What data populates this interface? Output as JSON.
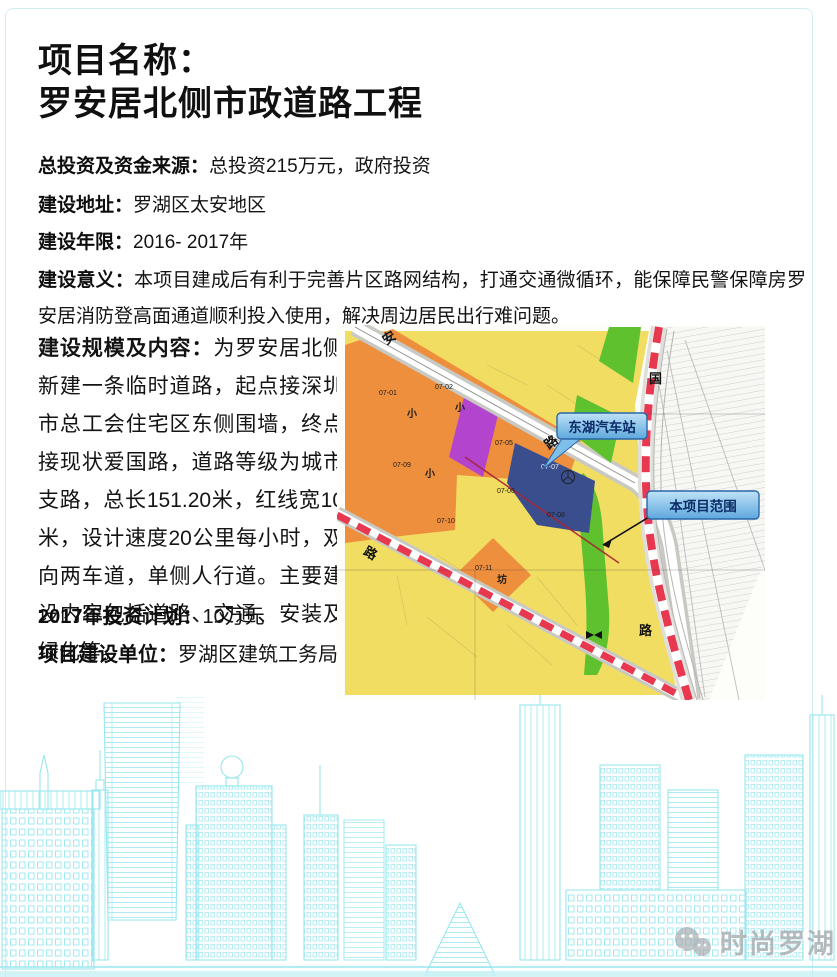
{
  "page": {
    "title_line1": "项目名称：",
    "title_line2": "罗安居北侧市政道路工程"
  },
  "fields": [
    {
      "label": "总投资及资金来源：",
      "value": "总投资215万元，政府投资"
    },
    {
      "label": "建设地址：",
      "value": "罗湖区太安地区"
    },
    {
      "label": "建设年限：",
      "value": "2016- 2017年"
    },
    {
      "label": "建设意义：",
      "value": "本项目建成后有利于完善片区路网结构，打通交通微循环，能保障民警保障房罗安居消防登高面通道顺利投入使用，解决周边居民出行难问题。"
    }
  ],
  "scale": {
    "label": "建设规模及内容：",
    "value": "为罗安居北侧新建一条临时道路，起点接深圳市总工会住宅区东侧围墙，终点接现状爱国路，道路等级为城市支路，总长151.20米，红线宽10米，设计速度20公里每小时，双向两车道，单侧人行道。主要建设内容包括道路、交通、安装及绿化等。"
  },
  "plan": {
    "label": "2017年投资计划：",
    "value": "10万元"
  },
  "unit": {
    "label": "项目建设单位：",
    "value": "罗湖区建筑工务局"
  },
  "map": {
    "callouts": {
      "station": "东湖汽车站",
      "scope": "本项目范围"
    },
    "road_labels": {
      "diag_top": "安",
      "diag_mid": "路",
      "right_top": "国",
      "right_bottom": "路",
      "lower_left": "路"
    },
    "zone_codes": {
      "z1": "07-01",
      "z2": "07-02",
      "z5": "07-05",
      "z6": "07-06",
      "z7": "07-07",
      "z8": "07-08",
      "z9": "07-09",
      "z10": "07-10",
      "z11": "07-11"
    },
    "zone_chars": {
      "c1": "小",
      "c2": "小",
      "c3": "小",
      "c4": "坊"
    },
    "colors": {
      "yellow": "#f1dd62",
      "orange": "#ee8f3e",
      "purple": "#b244ce",
      "navy": "#3a4e8e",
      "green": "#5ec12d",
      "red": "#e73850",
      "road_gray": "#c9c9c4",
      "boundary_red": "#a92432",
      "callout_border": "#2a66a8",
      "callout_text": "#0b2b66"
    }
  },
  "watermark": {
    "text": "时尚罗湖"
  }
}
